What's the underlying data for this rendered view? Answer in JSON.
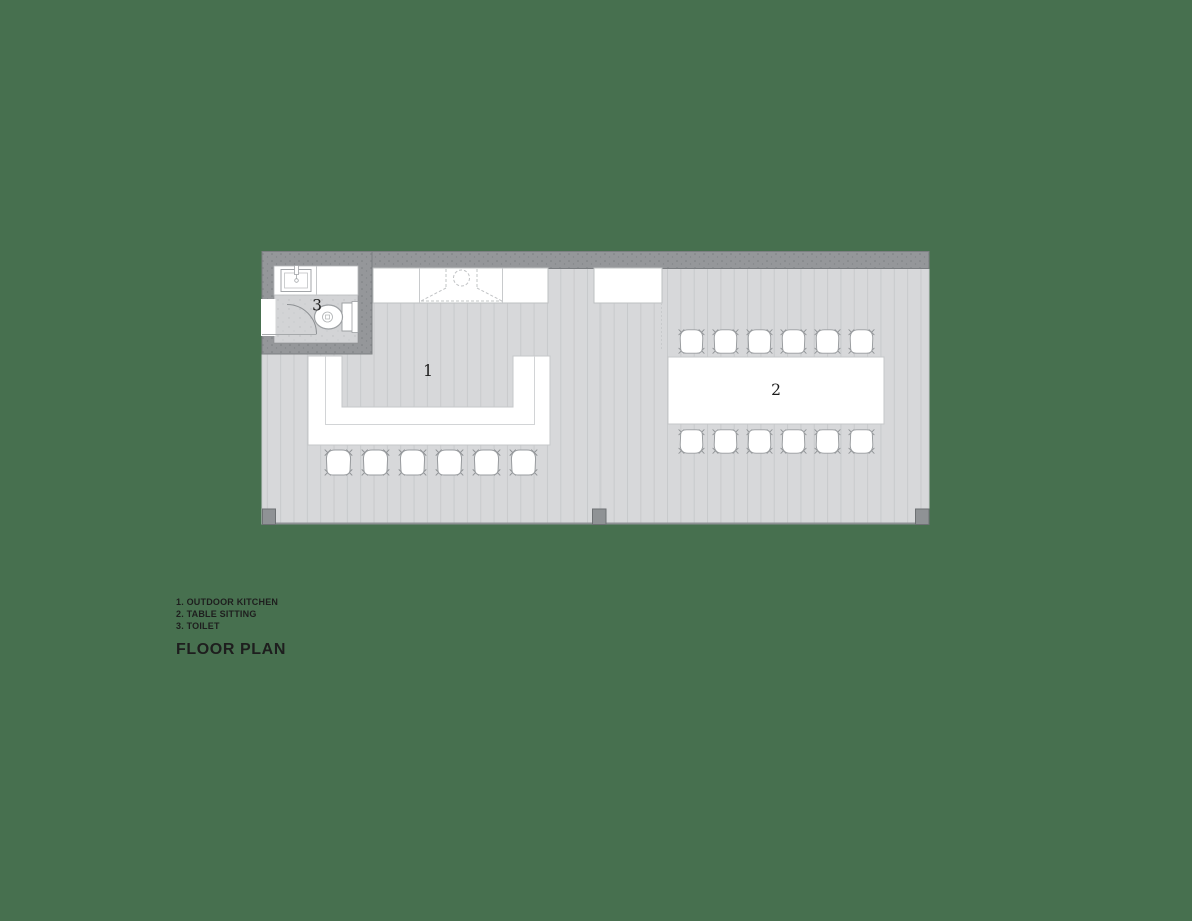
{
  "colors": {
    "background": "#47704F",
    "floor": "#D7D8DA",
    "plank-line": "#C8CACC",
    "wall": "#95979A",
    "wall-edge": "#7C7F82",
    "furniture": "#FFFFFF",
    "furniture-stroke": "#9A9DA0",
    "text": "#1E1E1E"
  },
  "plan": {
    "labels": {
      "outdoor_kitchen": "1",
      "table_sitting": "2",
      "toilet": "3"
    }
  },
  "legend": {
    "items": [
      "1. OUTDOOR KITCHEN",
      "2. TABLE SITTING",
      "3. TOILET"
    ],
    "title": "FLOOR PLAN"
  }
}
